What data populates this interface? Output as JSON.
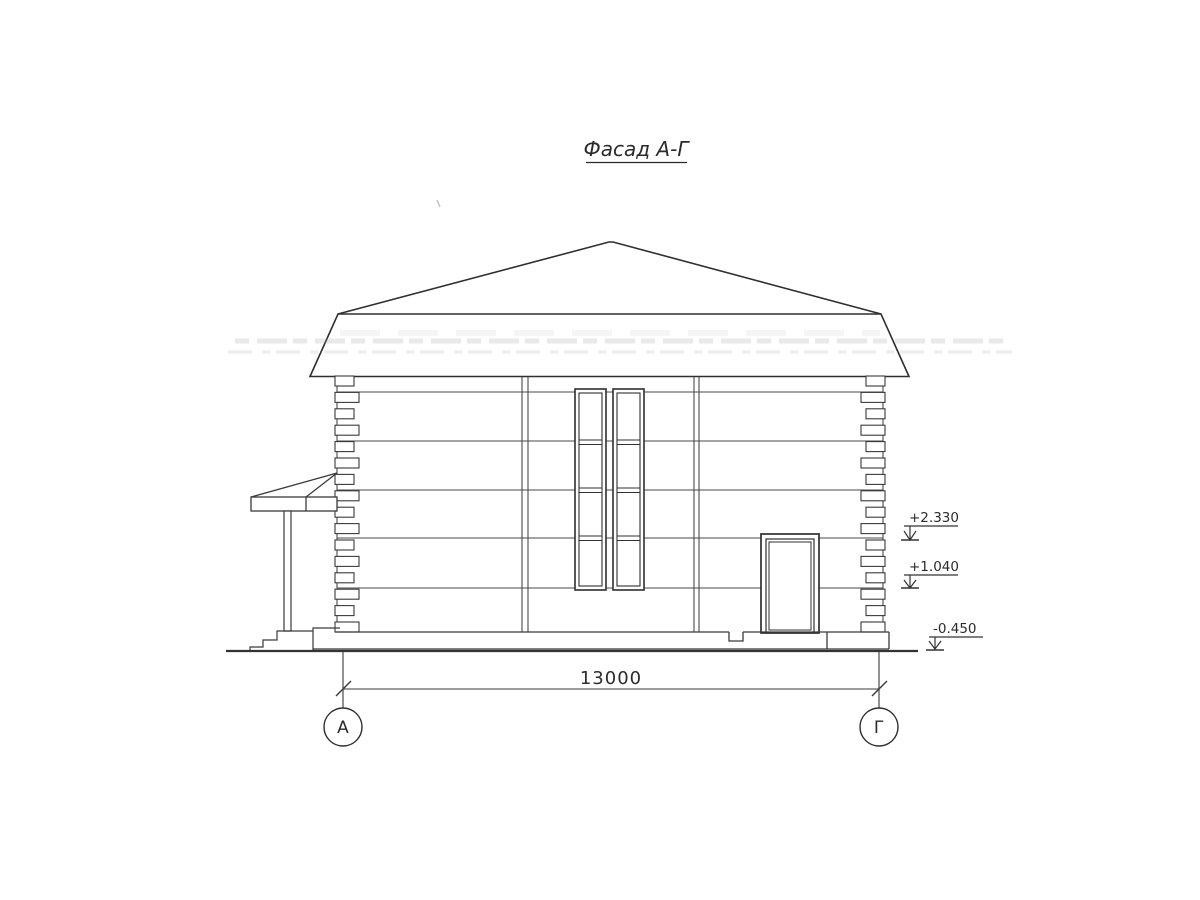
{
  "drawing": {
    "title": "Фасад А-Г",
    "dimension": {
      "value": "13000"
    },
    "axes": [
      {
        "label": "А"
      },
      {
        "label": "Г"
      }
    ],
    "elevation_marks": [
      {
        "value": "+2.330"
      },
      {
        "value": "+1.040"
      },
      {
        "value": "-0.450"
      }
    ],
    "colors": {
      "paper": "#ffffff",
      "ink": "#2f2f2f",
      "line_medium": "#4a4a4a"
    }
  }
}
